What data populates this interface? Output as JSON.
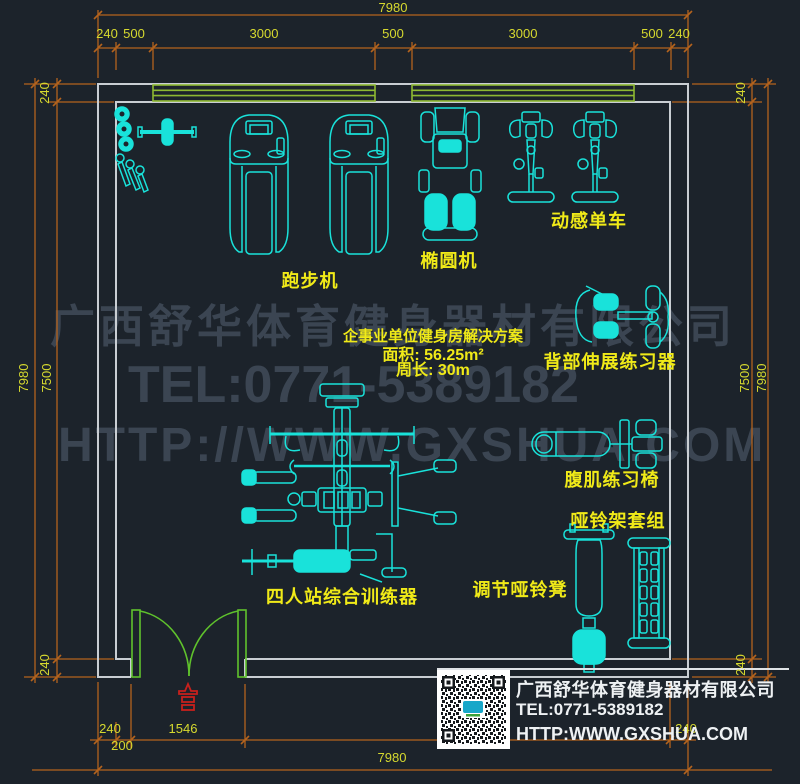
{
  "colors": {
    "background": "#1c232b",
    "wall": "#c9ced3",
    "equipment_cyan": "#19e2da",
    "dimension_orange": "#b4631d",
    "dimension_text_yellow": "#d6d92f",
    "label_yellow": "#f0ea18",
    "window_green": "#8eb932",
    "door_green": "#5fc22c",
    "entrance_red": "#c8201c",
    "watermark_gray": "#414c59",
    "footer_white": "#eef1f3"
  },
  "dims": {
    "top_total": "7980",
    "top_row": [
      "240",
      "500",
      "3000",
      "500",
      "3000",
      "500",
      "240"
    ],
    "left": {
      "top": "240",
      "outer": "7980",
      "inner": "7500",
      "bottom": "240"
    },
    "right": {
      "top": "240",
      "inner": "7500",
      "outer": "7980",
      "bottom": "240"
    },
    "bottom": {
      "wall": "240",
      "offset": "200",
      "door": "1546",
      "right": "240",
      "total": "7980"
    }
  },
  "labels": {
    "treadmill": "跑步机",
    "elliptical": "椭圆机",
    "spin_bike": "动感单车",
    "back_extension": "背部伸展练习器",
    "ab_chair": "腹肌练习椅",
    "dumbbell_rack": "哑铃架套组",
    "dumbbell_bench": "调节哑铃凳",
    "multi_station": "四人站综合训练器"
  },
  "plan_info": {
    "title": "企事业单位健身房解决方案",
    "area": "面积: 56.25m²",
    "perimeter": "周长: 30m"
  },
  "watermark": {
    "company": "广西舒华体育健身器材有限公司",
    "tel": "TEL:0771-5389182",
    "web": "HTTP://WWW.GXSHUA.COM"
  },
  "footer": {
    "company": "广西舒华体育健身器材有限公司",
    "tel": "TEL:0771-5389182",
    "web": "HTTP:WWW.GXSHUA.COM"
  }
}
